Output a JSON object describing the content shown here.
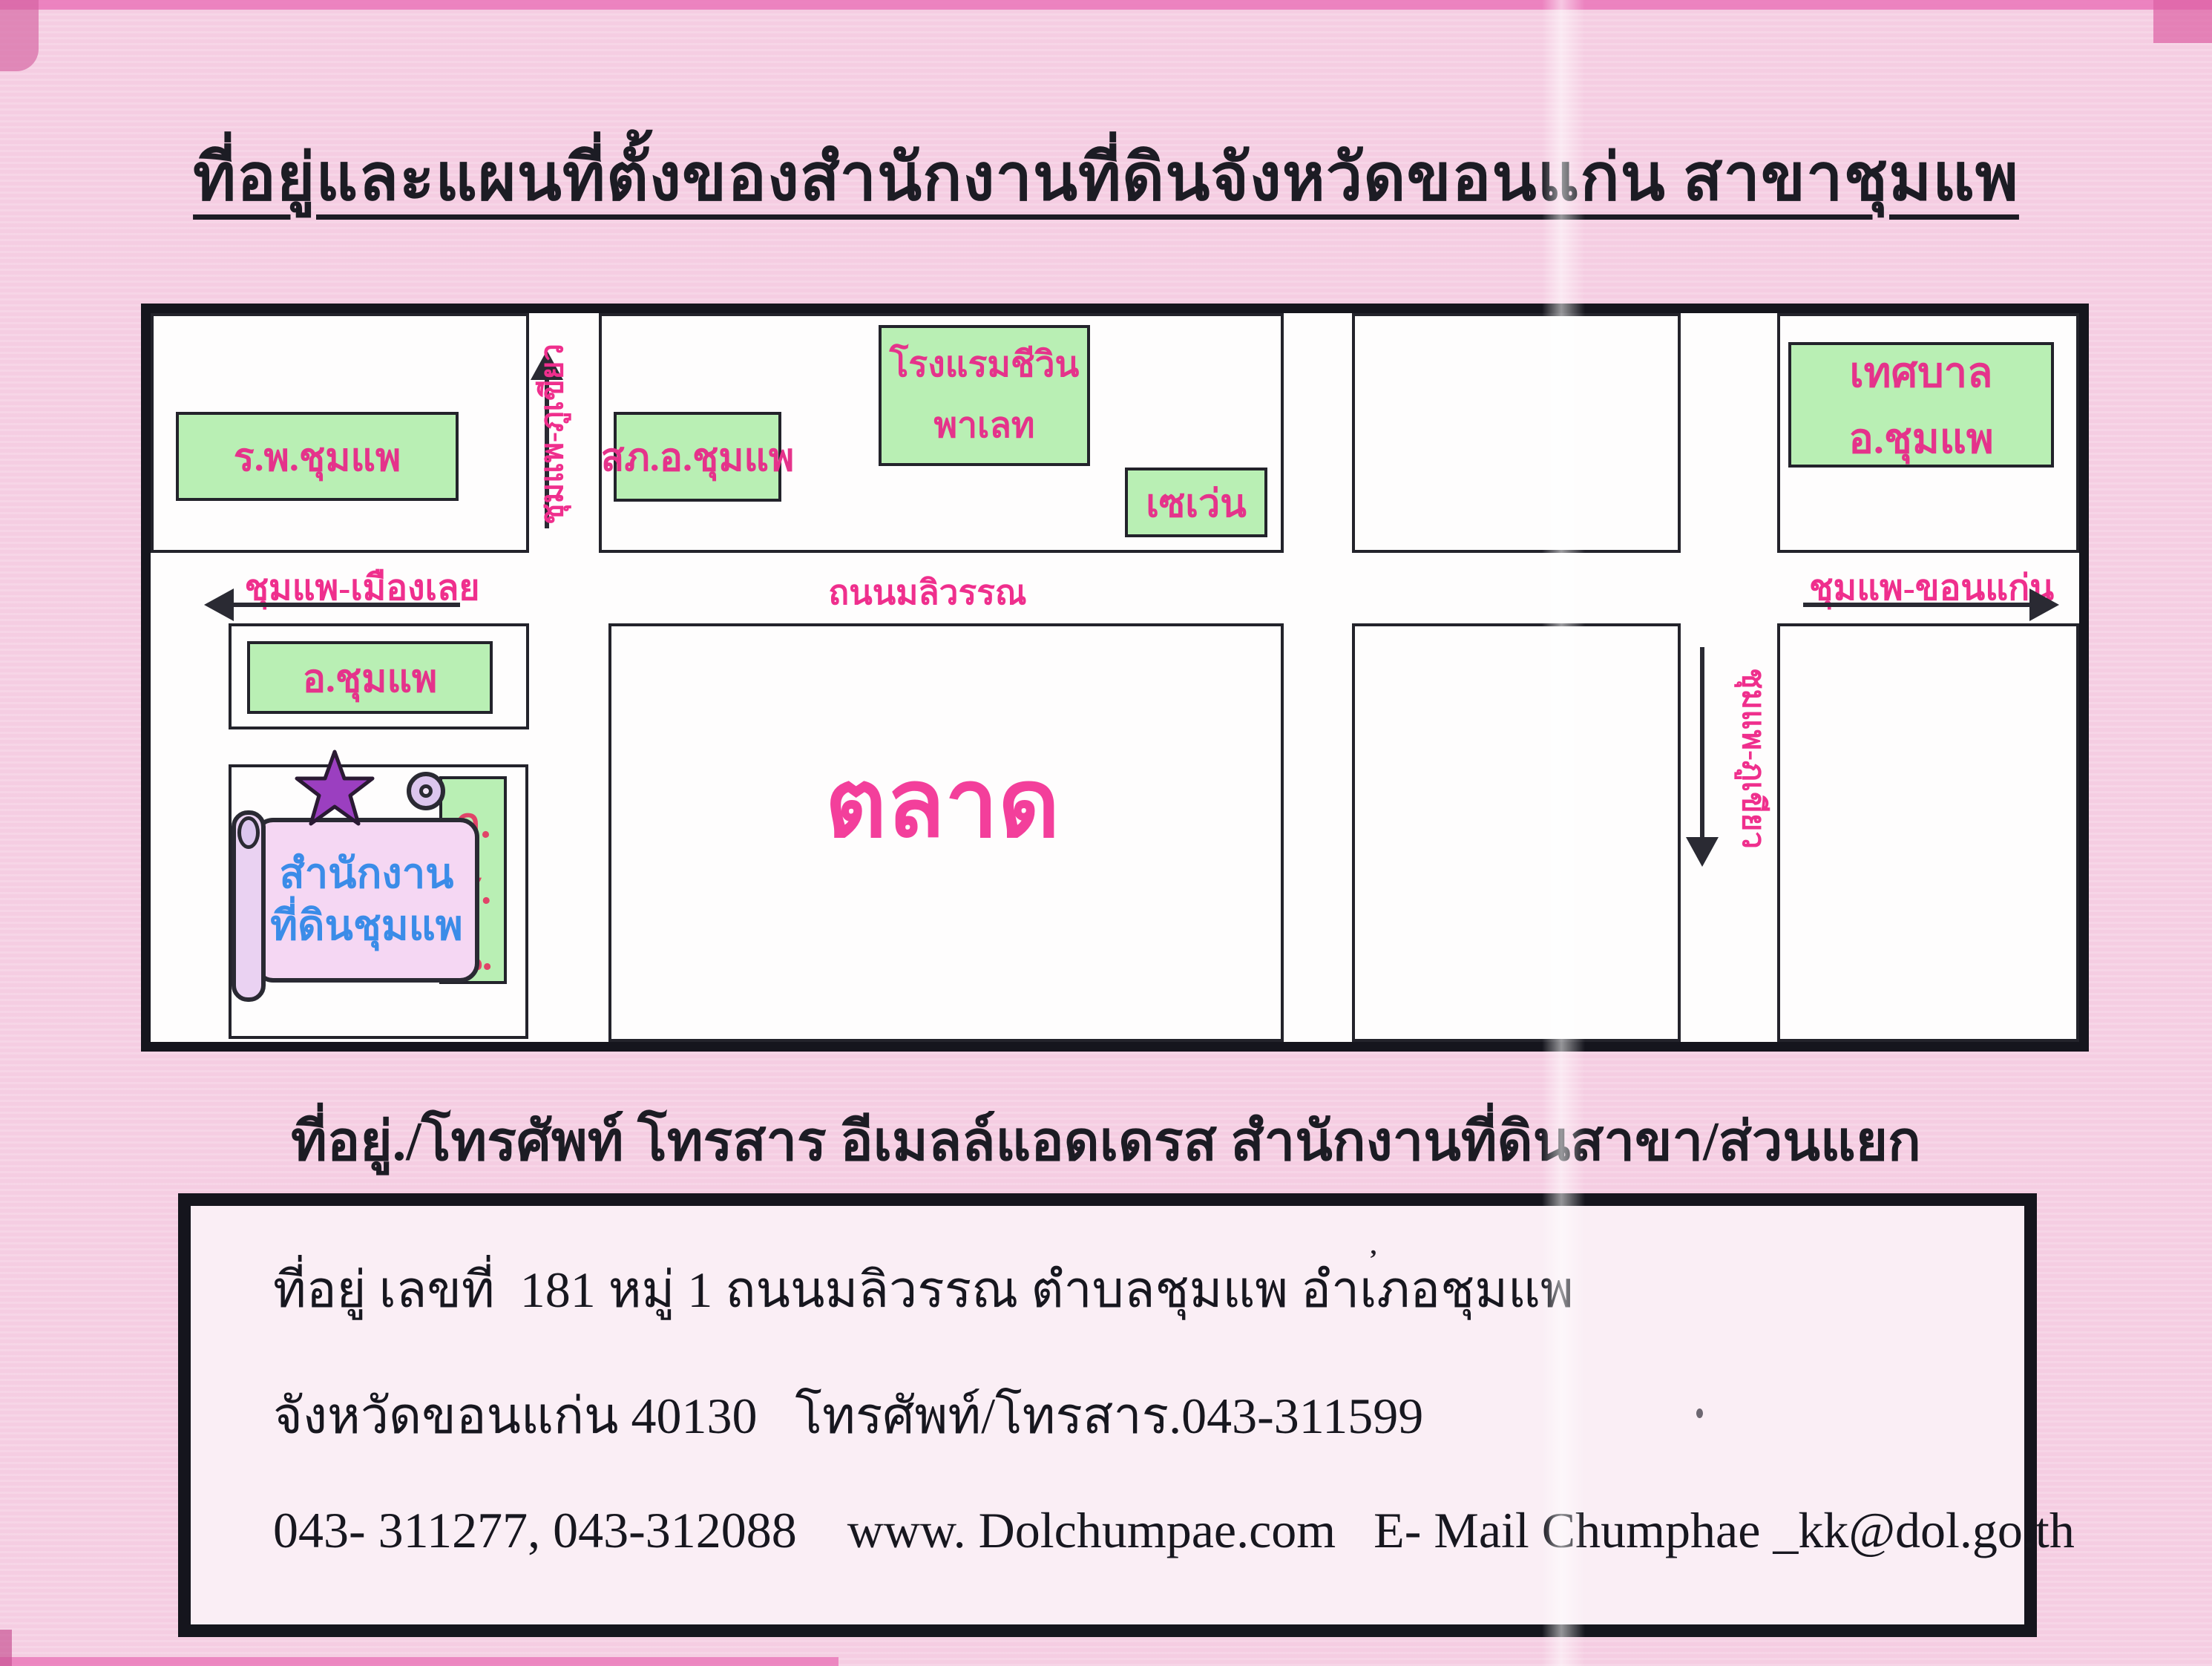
{
  "page": {
    "title": "ที่อยู่และแผนที่ตั้งของสำนักงานที่ดินจังหวัดขอนแก่น สาขาชุมแพ",
    "subtitle": "ที่อยู่./โทรศัพท์ โทรสาร อีเมลล์แอดเดรส สำนักงานที่ดินสาขา/ส่วนแยก"
  },
  "map": {
    "places": {
      "hospital": "ร.พ.ชุมแพ",
      "police_station": "สภ.อ.ชุมแพ",
      "hotel_line1": "โรงแรมชีวิน",
      "hotel_line2": "พาเลท",
      "seven_eleven": "เซเว่น",
      "municipality": "เทศบาล อ.ชุมแพ",
      "district_office": "อ.ชุมแพ",
      "market": "ตลาด",
      "land_office_line1": "สำนักงาน",
      "land_office_line2": "ที่ดินชุมแพ",
      "nfe": [
        "ก.",
        "ศ.",
        "น."
      ]
    },
    "roads": {
      "west_direction": "ชุมแพ-เมืองเลย",
      "main_road": "ถนนมลิวรรณ",
      "east_direction": "ชุมแพ-ขอนแก่น",
      "north_vertical": "ชุมแพ-ภูเขียว",
      "south_vertical": "ชุมแพ-ภูเขียว"
    }
  },
  "address_box": {
    "line1": "ที่อยู่ เลขที่  181 หมู่ 1 ถนนมลิวรรณ ตำบลชุมแพ อำเภอชุมแพ",
    "line2": "จังหวัดขอนแก่น 40130   โทรศัพท์/โทรสาร.043-311599",
    "line3": "043- 311277, 043-312088    www. Dolchumpae.com   E- Mail Chumphae _kk@dol.go.th"
  },
  "marks": {
    "speck": "’"
  },
  "colors": {
    "paper_pink": "#f5cde2",
    "building_green": "#b9efb4",
    "label_pink": "#e5338b",
    "market_pink": "#f33f9b",
    "office_blue": "#3b8ce8",
    "star_purple": "#9b3fc0",
    "nfe_red": "#e04468",
    "ink_black": "#15151d"
  }
}
